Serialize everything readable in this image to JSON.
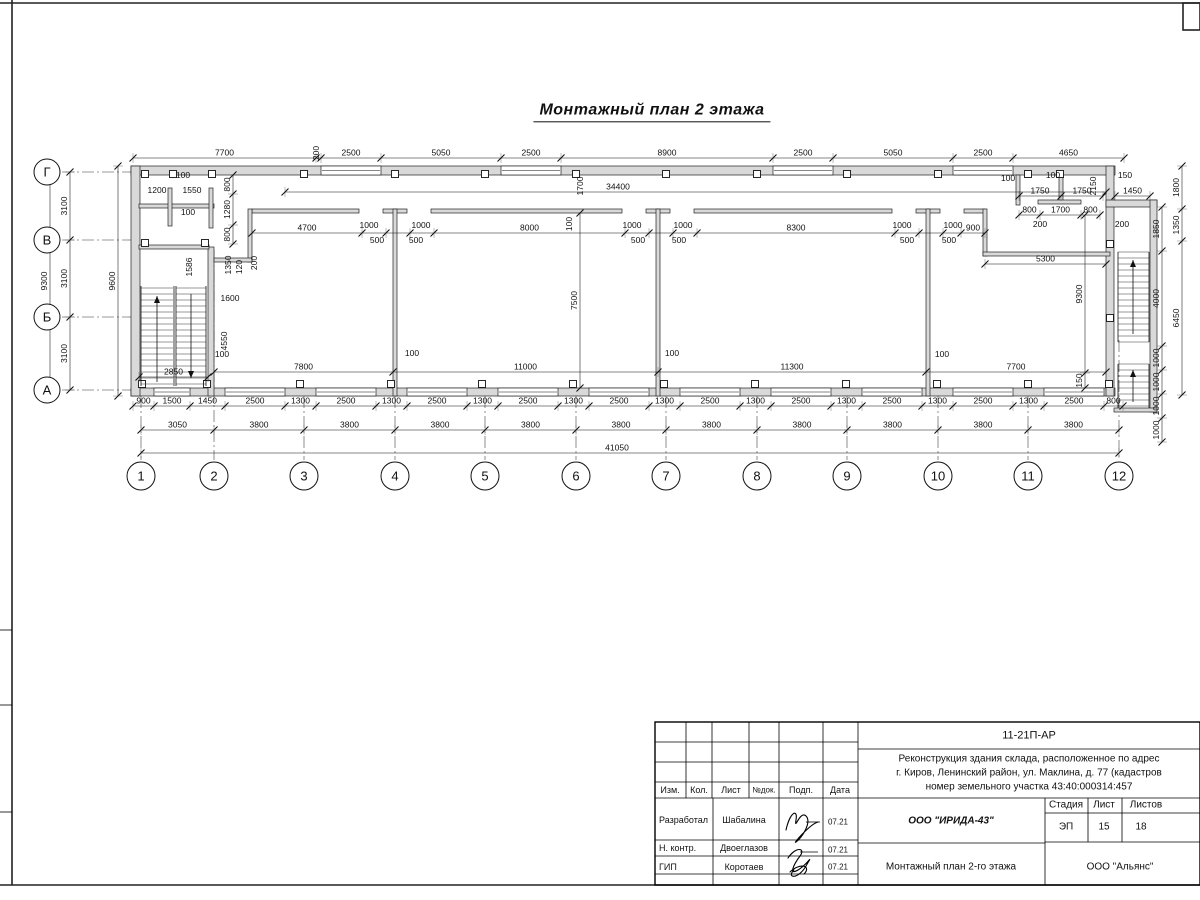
{
  "sheet": {
    "title": "Монтажный план 2 этажа"
  },
  "axes": {
    "vertical_letters": [
      "Г",
      "В",
      "Б",
      "А"
    ],
    "horizontal_numbers": [
      "1",
      "2",
      "3",
      "4",
      "5",
      "6",
      "7",
      "8",
      "9",
      "10",
      "11",
      "12"
    ]
  },
  "title_block": {
    "code": "11-21П-АР",
    "project_line1": "Реконструкция здания склада, расположенное по адрес",
    "project_line2": "г. Киров, Ленинский район, ул. Маклина, д. 77 (кадастров",
    "project_line3": "номер земельного участка 43:40:000314:457",
    "col_izm": "Изм.",
    "col_kol": "Кол.",
    "col_list": "Лист",
    "col_ndok": "№док.",
    "col_podp": "Подп.",
    "col_data": "Дата",
    "rows": [
      {
        "role": "Разработал",
        "name": "Шабалина",
        "date": "07.21"
      },
      {
        "role": "Н. контр.",
        "name": "Двоеглазов",
        "date": "07.21"
      },
      {
        "role": "ГИП",
        "name": "Коротаев",
        "date": "07.21"
      }
    ],
    "org": "ООО \"ИРИДА-43\"",
    "doc_title": "Монтажный план 2-го этажа",
    "company": "ООО \"Альянс\"",
    "stage_label": "Стадия",
    "sheet_label": "Лист",
    "sheets_label": "Листов",
    "stage": "ЭП",
    "sheet_no": "15",
    "sheets_total": "18"
  },
  "plan": {
    "axis_rows": {
      "x": 47,
      "r": 13,
      "items": [
        {
          "y": 172,
          "t": "Г"
        },
        {
          "y": 240,
          "t": "В"
        },
        {
          "y": 317,
          "t": "Б"
        },
        {
          "y": 390,
          "t": "А"
        }
      ]
    },
    "axis_cols": {
      "y": 476,
      "r": 14,
      "items": [
        {
          "x": 141,
          "t": "1"
        },
        {
          "x": 214,
          "t": "2"
        },
        {
          "x": 304,
          "t": "3"
        },
        {
          "x": 395,
          "t": "4"
        },
        {
          "x": 485,
          "t": "5"
        },
        {
          "x": 576,
          "t": "6"
        },
        {
          "x": 666,
          "t": "7"
        },
        {
          "x": 757,
          "t": "8"
        },
        {
          "x": 847,
          "t": "9"
        },
        {
          "x": 938,
          "t": "10"
        },
        {
          "x": 1028,
          "t": "11"
        },
        {
          "x": 1119,
          "t": "12"
        }
      ]
    },
    "walls": [
      [
        131,
        166,
        984,
        9
      ],
      [
        131,
        388,
        984,
        8
      ],
      [
        131,
        166,
        9,
        230
      ],
      [
        1106,
        166,
        8,
        230
      ],
      [
        252,
        209,
        107,
        4
      ],
      [
        383,
        209,
        24,
        4
      ],
      [
        431,
        209,
        191,
        4
      ],
      [
        646,
        209,
        24,
        4
      ],
      [
        694,
        209,
        198,
        4
      ],
      [
        916,
        209,
        24,
        4
      ],
      [
        964,
        209,
        21,
        4
      ],
      [
        393,
        209,
        4,
        187
      ],
      [
        656,
        209,
        4,
        187
      ],
      [
        926,
        209,
        4,
        187
      ],
      [
        983,
        209,
        4,
        47
      ],
      [
        983,
        252,
        127,
        4
      ],
      [
        208,
        247,
        6,
        149
      ],
      [
        139,
        245,
        70,
        4
      ],
      [
        248,
        209,
        4,
        53
      ],
      [
        214,
        258,
        38,
        4
      ],
      [
        139,
        204,
        75,
        4
      ],
      [
        168,
        188,
        4,
        38
      ],
      [
        209,
        188,
        4,
        40
      ],
      [
        1016,
        175,
        4,
        30
      ],
      [
        1059,
        175,
        4,
        27
      ],
      [
        1038,
        200,
        43,
        4
      ],
      [
        1106,
        200,
        51,
        7
      ],
      [
        1150,
        200,
        7,
        212
      ],
      [
        1114,
        408,
        43,
        4
      ]
    ],
    "windows": [
      [
        321,
        166,
        60,
        9
      ],
      [
        501,
        166,
        60,
        9
      ],
      [
        773,
        166,
        60,
        9
      ],
      [
        953,
        166,
        60,
        9
      ],
      [
        154,
        388,
        36,
        8
      ],
      [
        225,
        388,
        60,
        8
      ],
      [
        316,
        388,
        60,
        8
      ],
      [
        407,
        388,
        60,
        8
      ],
      [
        498,
        388,
        60,
        8
      ],
      [
        589,
        388,
        60,
        8
      ],
      [
        680,
        388,
        60,
        8
      ],
      [
        771,
        388,
        60,
        8
      ],
      [
        862,
        388,
        60,
        8
      ],
      [
        953,
        388,
        60,
        8
      ],
      [
        1044,
        388,
        60,
        8
      ]
    ],
    "squares": [
      [
        145,
        174
      ],
      [
        173,
        174
      ],
      [
        212,
        174
      ],
      [
        304,
        174
      ],
      [
        395,
        174
      ],
      [
        485,
        174
      ],
      [
        576,
        174
      ],
      [
        666,
        174
      ],
      [
        757,
        174
      ],
      [
        847,
        174
      ],
      [
        938,
        174
      ],
      [
        1028,
        174
      ],
      [
        1060,
        174
      ],
      [
        142,
        384
      ],
      [
        207,
        384
      ],
      [
        300,
        384
      ],
      [
        391,
        384
      ],
      [
        482,
        384
      ],
      [
        573,
        384
      ],
      [
        664,
        384
      ],
      [
        755,
        384
      ],
      [
        846,
        384
      ],
      [
        937,
        384
      ],
      [
        1028,
        384
      ],
      [
        1109,
        384
      ],
      [
        145,
        243
      ],
      [
        205,
        243
      ],
      [
        1110,
        244
      ],
      [
        1110,
        318
      ]
    ],
    "stairs": {
      "runs": [
        {
          "x1": 141,
          "x2": 173,
          "y1": 288,
          "y2": 384,
          "step": 6
        },
        {
          "x1": 176,
          "x2": 206,
          "y1": 288,
          "y2": 384,
          "step": 6
        },
        {
          "x1": 1118,
          "x2": 1149,
          "y1": 252,
          "y2": 342,
          "step": 6
        },
        {
          "x1": 1118,
          "x2": 1149,
          "y1": 364,
          "y2": 408,
          "step": 6
        }
      ],
      "lines": [
        [
          141,
          286,
          141,
          386
        ],
        [
          206,
          286,
          206,
          386
        ],
        [
          174,
          286,
          174,
          386
        ],
        [
          176,
          286,
          176,
          386
        ],
        [
          1118,
          252,
          1118,
          342
        ],
        [
          1149,
          252,
          1149,
          342
        ],
        [
          1118,
          364,
          1118,
          408
        ],
        [
          1149,
          364,
          1149,
          408
        ]
      ],
      "arrows": [
        {
          "x": 157,
          "y1": 382,
          "y2": 296
        },
        {
          "x": 191,
          "y1": 294,
          "y2": 378
        },
        {
          "x": 1133,
          "y1": 334,
          "y2": 260
        },
        {
          "x": 1133,
          "y1": 402,
          "y2": 370
        }
      ]
    },
    "hdims": [
      {
        "y": 158,
        "xs": [
          133,
          316,
          321,
          381,
          501,
          561,
          773,
          833,
          953,
          1013,
          1124
        ],
        "labels": [
          "7700",
          "",
          "2500",
          "5050",
          "2500",
          "8900",
          "2500",
          "5050",
          "2500",
          "4650"
        ]
      },
      {
        "y": 406,
        "xs": [
          133,
          154,
          190,
          225,
          285,
          316,
          376,
          407,
          467,
          498,
          558,
          589,
          649,
          680,
          740,
          771,
          831,
          862,
          922,
          953,
          1013,
          1044,
          1104,
          1123
        ],
        "labels": [
          "900",
          "1500",
          "1450",
          "2500",
          "1300",
          "2500",
          "1300",
          "2500",
          "1300",
          "2500",
          "1300",
          "2500",
          "1300",
          "2500",
          "1300",
          "2500",
          "1300",
          "2500",
          "1300",
          "2500",
          "1300",
          "2500",
          "800"
        ]
      },
      {
        "y": 430,
        "xs": [
          141,
          214,
          304,
          395,
          485,
          576,
          666,
          757,
          847,
          938,
          1028,
          1119
        ],
        "labels": [
          "3050",
          "3800",
          "3800",
          "3800",
          "3800",
          "3800",
          "3800",
          "3800",
          "3800",
          "3800",
          "3800"
        ]
      },
      {
        "y": 453,
        "xs": [
          141,
          1119
        ],
        "labels": [
          "41050"
        ],
        "lx": 617
      },
      {
        "y": 192,
        "xs": [
          285,
          1106
        ],
        "labels": [
          "34400"
        ],
        "lx": 618
      },
      {
        "y": 233,
        "xs": [
          252,
          362,
          386,
          410,
          434,
          625,
          649,
          673,
          697,
          895,
          919,
          943,
          961,
          985
        ],
        "labels": [
          "4700",
          "",
          "",
          "",
          "8000",
          "",
          "",
          "",
          "8300",
          "",
          "",
          "",
          "900"
        ]
      },
      {
        "y": 372,
        "xs": [
          214,
          393,
          658,
          926,
          1106
        ],
        "labels": [
          "7800",
          "11000",
          "11300",
          "7700"
        ]
      },
      {
        "y": 377,
        "xs": [
          139,
          208
        ],
        "labels": [
          "2850"
        ]
      },
      {
        "y": 264,
        "xs": [
          985,
          1106
        ],
        "labels": [
          "5300"
        ]
      },
      {
        "y": 196,
        "xs": [
          1019,
          1061,
          1103
        ],
        "labels": [
          "1750",
          "1750"
        ]
      },
      {
        "y": 196,
        "xs": [
          1115,
          1150
        ],
        "labels": [
          "1450"
        ]
      },
      {
        "y": 215,
        "xs": [
          1019,
          1040,
          1081,
          1100
        ],
        "labels": [
          "800",
          "1700",
          "800"
        ]
      }
    ],
    "vdims": [
      {
        "x": 70,
        "ys": [
          172,
          240,
          317,
          390
        ],
        "labels": [
          "3100",
          "3100",
          "3100"
        ]
      },
      {
        "x": 50,
        "ys": [
          172,
          390
        ],
        "labels": [
          "9300"
        ]
      },
      {
        "x": 118,
        "ys": [
          166,
          396
        ],
        "labels": [
          "9600"
        ]
      },
      {
        "x": 1162,
        "ys": [
          207,
          251,
          346,
          370,
          394,
          418,
          442
        ],
        "labels": [
          "1850",
          "4000",
          "1000",
          "1000",
          "1000",
          "1000"
        ]
      },
      {
        "x": 1182,
        "ys": [
          166,
          209,
          241,
          395
        ],
        "labels": [
          "1800",
          "1350",
          "6450"
        ]
      },
      {
        "x": 233,
        "ys": [
          175,
          194,
          225,
          244
        ],
        "labels": [
          "800",
          "1280",
          "800"
        ]
      },
      {
        "x": 580,
        "ys": [
          213,
          388
        ],
        "labels": [
          "7500"
        ]
      },
      {
        "x": 1085,
        "ys": [
          215,
          373,
          388
        ],
        "labels": [
          "9300",
          "150"
        ]
      }
    ],
    "floats": [
      [
        319,
        153,
        "200",
        1
      ],
      [
        183,
        178,
        "100",
        0
      ],
      [
        157,
        193,
        "1200",
        0
      ],
      [
        192,
        193,
        "1550",
        0
      ],
      [
        188,
        215,
        "100",
        0
      ],
      [
        583,
        186,
        "1700",
        1
      ],
      [
        572,
        224,
        "100",
        1
      ],
      [
        369,
        228,
        "1000",
        0
      ],
      [
        377,
        243,
        "500",
        0
      ],
      [
        421,
        228,
        "1000",
        0
      ],
      [
        416,
        243,
        "500",
        0
      ],
      [
        632,
        228,
        "1000",
        0
      ],
      [
        638,
        243,
        "500",
        0
      ],
      [
        683,
        228,
        "1000",
        0
      ],
      [
        679,
        243,
        "500",
        0
      ],
      [
        902,
        228,
        "1000",
        0
      ],
      [
        907,
        243,
        "500",
        0
      ],
      [
        953,
        228,
        "1000",
        0
      ],
      [
        949,
        243,
        "500",
        0
      ],
      [
        192,
        267,
        "1586",
        1
      ],
      [
        231,
        265,
        "1350",
        1
      ],
      [
        242,
        267,
        "120",
        1
      ],
      [
        257,
        263,
        "200",
        1
      ],
      [
        230,
        301,
        "1600",
        0
      ],
      [
        227,
        341,
        "4550",
        1
      ],
      [
        222,
        357,
        "100",
        0
      ],
      [
        412,
        356,
        "100",
        0
      ],
      [
        672,
        356,
        "100",
        0
      ],
      [
        942,
        357,
        "100",
        0
      ],
      [
        1008,
        181,
        "100",
        0
      ],
      [
        1053,
        178,
        "100",
        0
      ],
      [
        1125,
        178,
        "150",
        0
      ],
      [
        1096,
        186,
        "2150",
        1
      ],
      [
        1040,
        227,
        "200",
        0
      ],
      [
        1122,
        227,
        "200",
        0
      ]
    ]
  }
}
